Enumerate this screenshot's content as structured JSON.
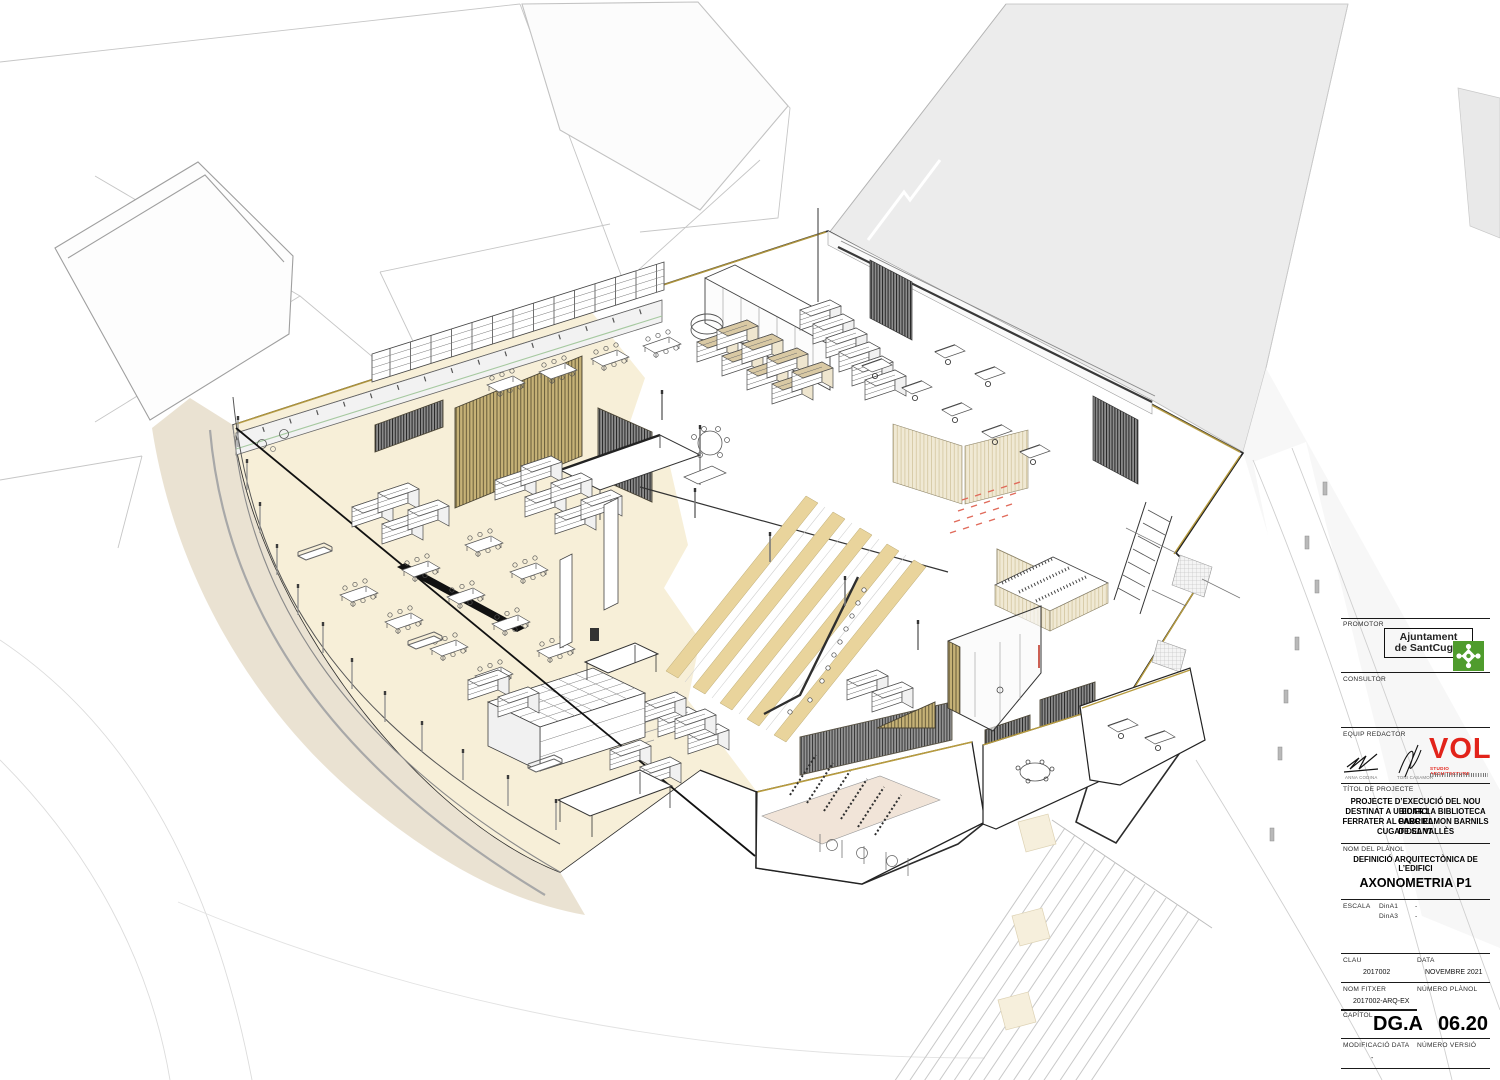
{
  "colors": {
    "logo-green": "#4f9c2d",
    "logo-red": "#e2231a",
    "accent-olive": "#b79b3e",
    "floor-cream": "#f7efd8",
    "step-tan": "#e9d49c",
    "terrain-tan": "#e6ddca",
    "context-gray": "#ececec",
    "marker-red": "#e06a5a"
  },
  "title_block": {
    "promotor": {
      "label": "PROMOTOR",
      "logo_line1": "Ajuntament",
      "logo_line2": "de SantCugat"
    },
    "consultor": {
      "label": "CONSULTOR"
    },
    "equip_redactor": {
      "label": "EQUIP REDACTOR",
      "signer1": "ANNA CODINA",
      "signer2": "TONI CASAMOR",
      "studio_name": "VOL",
      "studio_subtitle": "STUDIO ARCHITECTURE"
    },
    "titol": {
      "label": "TÍTOL DE PROJECTE",
      "line1": "PROJECTE D’EXECUCIÓ DEL NOU EDIFICI",
      "line2": "DESTINAT A UBICAR LA BIBLIOTECA GABRIEL",
      "line3": "FERRATER AL PARC RAMON BARNILS DE SANT",
      "line4": "CUGAT DEL VALLÈS"
    },
    "planol": {
      "label": "NOM DEL PLÀNOL",
      "name": "DEFINICIÓ ARQUITECTÒNICA DE L’EDIFICI",
      "drawing_title": "AXONOMETRIA P1"
    },
    "escala": {
      "label": "ESCALA",
      "row1_format": "DinA1",
      "row1_value": "-",
      "row2_format": "DinA3",
      "row2_value": "-"
    },
    "clau": {
      "label": "CLAU",
      "value": "2017002"
    },
    "data": {
      "label": "DATA",
      "value": "NOVEMBRE 2021"
    },
    "fitxer": {
      "label": "NOM FITXER",
      "value": "2017002-ARQ-EX"
    },
    "numero_planol": {
      "label": "NÚMERO PLÀNOL",
      "value": "06.20"
    },
    "capitol": {
      "label": "CAPÍTOL",
      "value": "DG.A"
    },
    "modificacio": {
      "label": "MODIFICACIÓ DATA",
      "value": "-"
    },
    "versio": {
      "label": "NÚMERO VERSIÓ"
    }
  }
}
